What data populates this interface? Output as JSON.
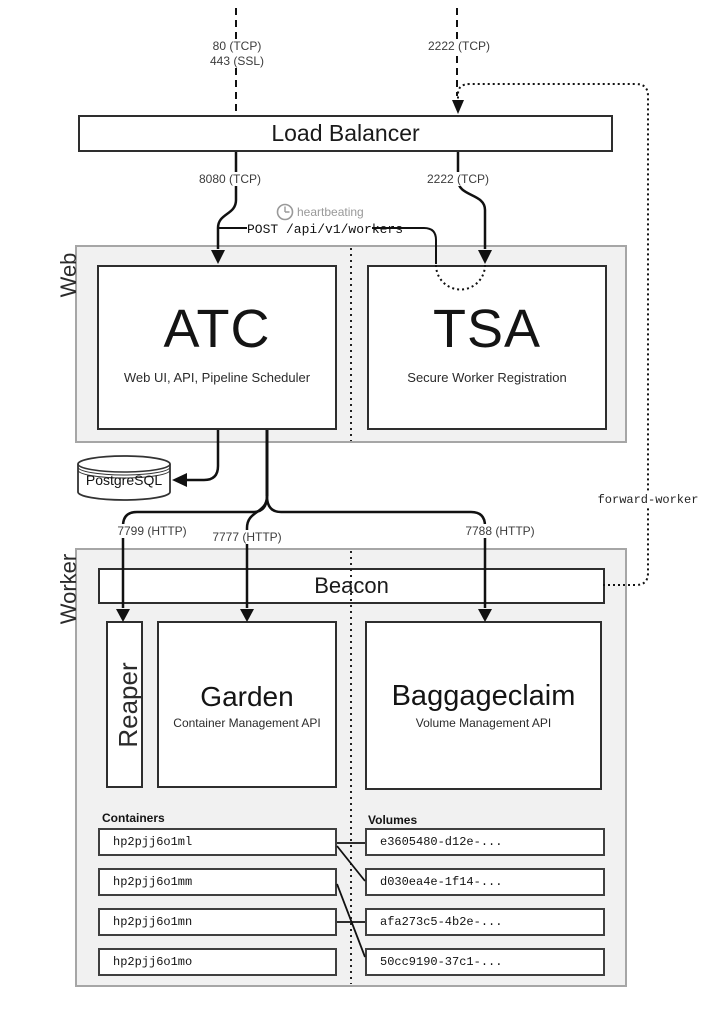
{
  "top_ports": {
    "http": "80 (TCP)",
    "https": "443 (SSL)",
    "ssh": "2222 (TCP)"
  },
  "load_balancer": {
    "title": "Load Balancer",
    "web_port": "8080 (TCP)",
    "ssh_port": "2222 (TCP)"
  },
  "heartbeat": {
    "icon": "clock-icon",
    "label": "heartbeating",
    "post_request_masked": "POST /api/v1/wor",
    "post_request_tail": "kers"
  },
  "web_section": {
    "label": "Web",
    "atc": {
      "title": "ATC",
      "subtitle": "Web UI, API, Pipeline Scheduler"
    },
    "tsa": {
      "title": "TSA",
      "subtitle": "Secure Worker Registration"
    }
  },
  "database": {
    "label": "PostgreSQL"
  },
  "forward_worker": {
    "label": "forward-worker"
  },
  "worker_section": {
    "label": "Worker",
    "beacon": {
      "title": "Beacon"
    },
    "ports": {
      "reaper": "7799 (HTTP)",
      "garden": "7777 (HTTP)",
      "baggageclaim": "7788 (HTTP)"
    },
    "reaper": {
      "title": "Reaper"
    },
    "garden": {
      "title": "Garden",
      "subtitle": "Container Management API"
    },
    "baggageclaim": {
      "title": "Baggageclaim",
      "subtitle": "Volume Management API"
    },
    "containers": {
      "heading": "Containers",
      "items": [
        "hp2pjj6o1ml",
        "hp2pjj6o1mm",
        "hp2pjj6o1mn",
        "hp2pjj6o1mo"
      ]
    },
    "volumes": {
      "heading": "Volumes",
      "items": [
        "e3605480-d12e-...",
        "d030ea4e-1f14-...",
        "afa273c5-4b2e-...",
        "50cc9190-37c1-..."
      ]
    }
  }
}
